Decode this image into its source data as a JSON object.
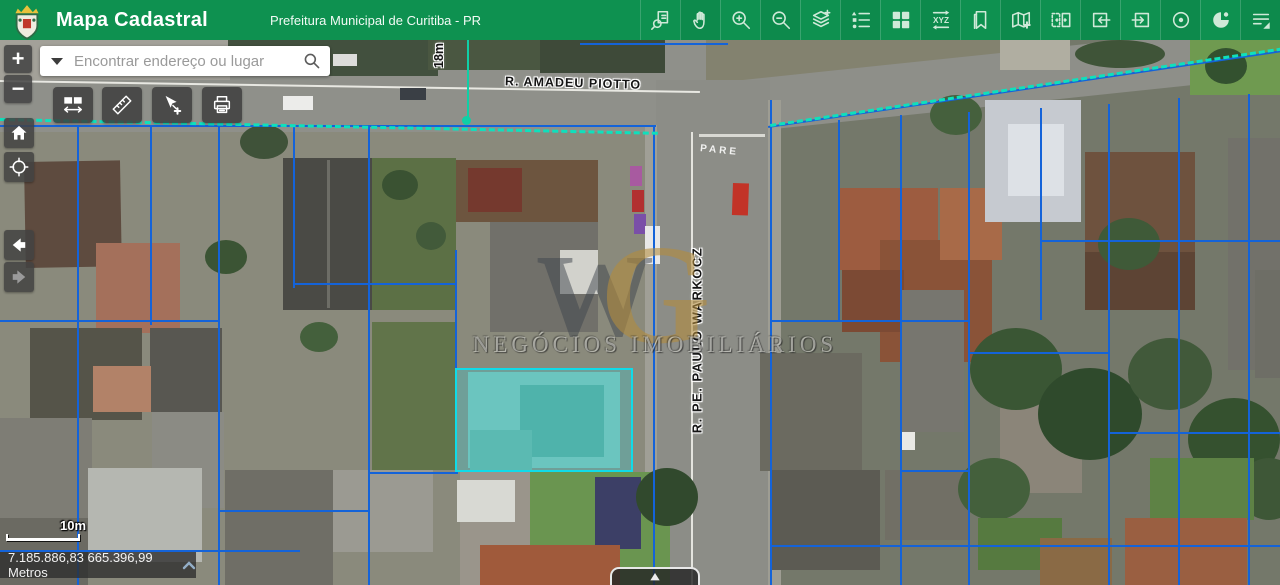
{
  "header": {
    "logo_icon": "curitiba-coat-of-arms",
    "title": "Mapa Cadastral",
    "subtitle": "Prefeitura Municipal de Curitiba - PR",
    "toolbar_icons": [
      "find-features-icon",
      "pan-hand-icon",
      "zoom-in-magnifier-icon",
      "zoom-out-magnifier-icon",
      "add-layers-icon",
      "legend-list-icon",
      "basemap-grid-icon",
      "xyz-coordinates-icon",
      "bookmark-icon",
      "add-map-notes-icon",
      "swipe-compare-icon",
      "extent-left-icon",
      "extent-right-icon",
      "around-point-icon",
      "overview-map-icon",
      "draw-menu-icon"
    ]
  },
  "map_controls": {
    "zoom_in_label": "+",
    "zoom_out_label": "−",
    "search": {
      "placeholder": "Encontrar endereço ou lugar",
      "value": ""
    },
    "tool_icons": [
      "basemap-compare-icon",
      "measure-ruler-icon",
      "select-features-icon",
      "print-icon"
    ],
    "nav_icons": [
      "home-icon",
      "locate-crosshair-icon",
      "back-arrow-icon",
      "forward-arrow-icon"
    ],
    "scale_bar_label": "10m",
    "coordinates_readout": "7.185.886,83 665.396,99 Metros",
    "attribute_panel_toggle_icon": "arrow-up-icon"
  },
  "map_labels": {
    "street_horizontal": "R. AMADEU PIOTTO",
    "street_vertical": "R. PE. PAULO WARKOCZ",
    "street_width": "18m",
    "road_marking": "PARE"
  },
  "watermark": {
    "monogram_w": "W",
    "monogram_g": "G",
    "text": "NEGÓCIOS IMOBILIÁRIOS"
  },
  "colors": {
    "header_green": "#0e9150",
    "parcel_blue": "#1463d9",
    "selection_cyan": "#10dbe8",
    "guide_teal_dashed": "#0fe0bc"
  }
}
